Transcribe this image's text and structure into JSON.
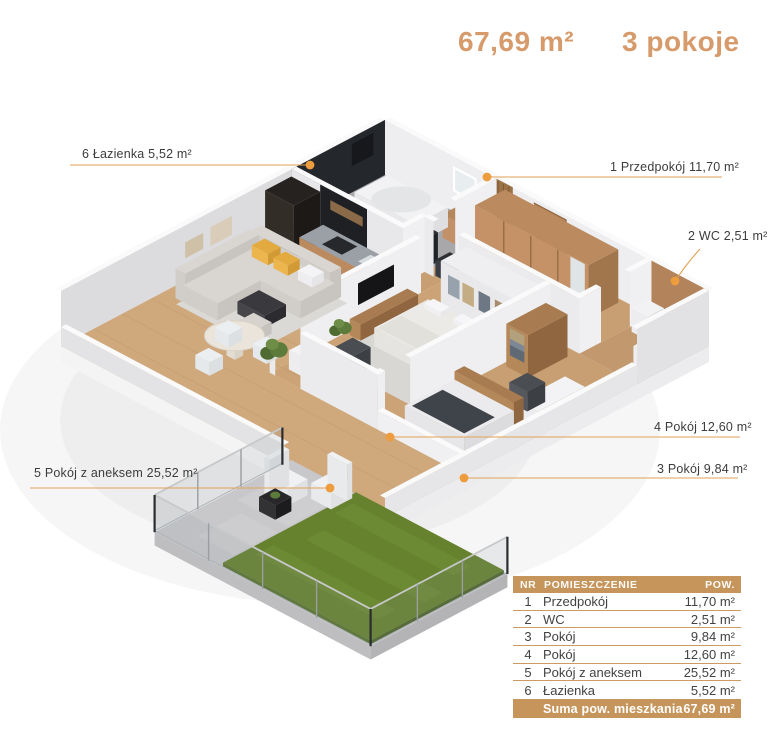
{
  "header": {
    "area": "67,69 m²",
    "rooms": "3 pokoje"
  },
  "labels": [
    {
      "nr": "6",
      "text": "6 Łazienka 5,52 m²"
    },
    {
      "nr": "1",
      "text": "1 Przedpokój 11,70 m²"
    },
    {
      "nr": "2",
      "text": "2 WC 2,51 m²"
    },
    {
      "nr": "4",
      "text": "4 Pokój 12,60 m²"
    },
    {
      "nr": "3",
      "text": "3 Pokój 9,84 m²"
    },
    {
      "nr": "5",
      "text": "5 Pokój z aneksem 25,52 m²"
    }
  ],
  "table": {
    "columns": [
      "NR",
      "POMIESZCZENIE",
      "POW."
    ],
    "rows": [
      {
        "nr": "1",
        "name": "Przedpokój",
        "area": "11,70 m²"
      },
      {
        "nr": "2",
        "name": "WC",
        "area": "2,51 m²"
      },
      {
        "nr": "3",
        "name": "Pokój",
        "area": "9,84 m²"
      },
      {
        "nr": "4",
        "name": "Pokój",
        "area": "12,60 m²"
      },
      {
        "nr": "5",
        "name": "Pokój z aneksem",
        "area": "25,52 m²"
      },
      {
        "nr": "6",
        "name": "Łazienka",
        "area": "5,52 m²"
      }
    ],
    "footer": {
      "label": "Suma pow. mieszkania",
      "value": "67,69 m²"
    }
  },
  "colors": {
    "accent_tan": "#c6955c",
    "leader_line": "#e2a156",
    "leader_dot": "#ed9c3e",
    "title_text": "#d69a6b",
    "label_text": "#3c3c3c",
    "grass": "#66822f",
    "dark_wall": "#24272c",
    "wood_floor": "#cfa87c"
  }
}
